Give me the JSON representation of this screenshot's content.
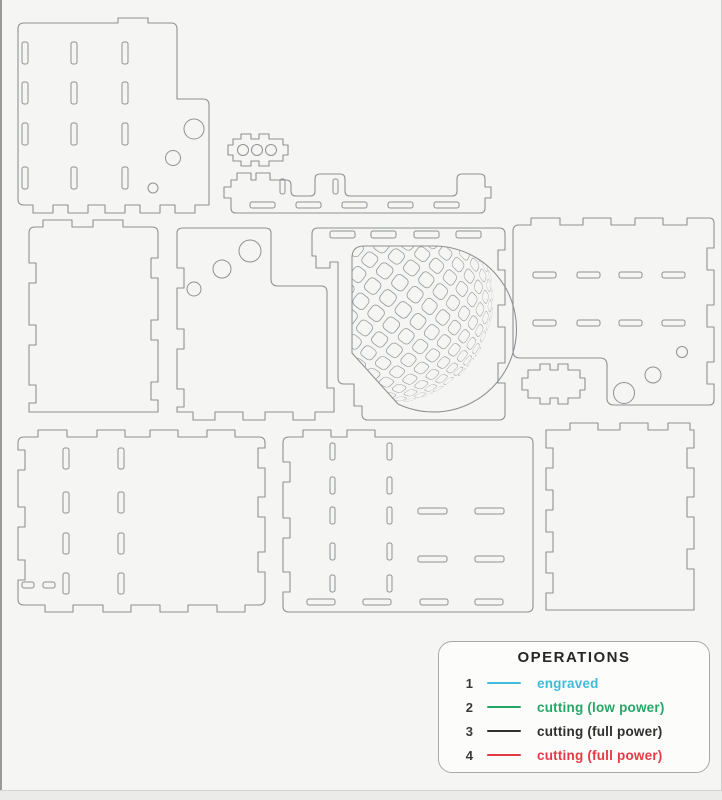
{
  "drawing": {
    "background": "#f5f5f3",
    "line_color": "#8f9193",
    "dimple_color": "#9aa0a3",
    "panels": [
      {
        "name": "panel-top-left",
        "outline": "M 24,23 H 118 V 18 H 148 V 23 H 171 Q 177,23 177,29 V 99 H 203 Q 209,99 209,105 V 205 H 195 V 213 H 175 V 205 H 160 V 213 H 140 V 205 H 125 V 213 H 105 V 205 H 88 V 213 H 68 V 205 H 53 V 213 H 33 V 205 H 24 Q 18,205 18,199 V 29 Q 18,23 24,23 Z",
        "slots": [
          [
            22,
            42,
            6,
            22
          ],
          [
            22,
            82,
            6,
            22
          ],
          [
            22,
            123,
            6,
            22
          ],
          [
            22,
            167,
            6,
            22
          ],
          [
            71,
            42,
            6,
            22
          ],
          [
            71,
            82,
            6,
            22
          ],
          [
            71,
            123,
            6,
            22
          ],
          [
            71,
            167,
            6,
            22
          ],
          [
            122,
            42,
            6,
            22
          ],
          [
            122,
            82,
            6,
            22
          ],
          [
            122,
            123,
            6,
            22
          ],
          [
            122,
            167,
            6,
            22
          ]
        ],
        "circles": [
          [
            194,
            129,
            10
          ],
          [
            173,
            158,
            7.5
          ],
          [
            153,
            188,
            5
          ]
        ]
      },
      {
        "name": "small-tabbed-plate",
        "outline": "M 228,145 V 155 H 233 V 161 H 241 V 166 H 251 V 161 H 259 V 166 H 269 V 161 H 283 V 155 H 288 V 145 H 283 V 139 H 269 V 134 H 259 V 139 H 251 V 134 H 241 V 139 H 233 V 145 Z",
        "slots": [],
        "circles": [
          [
            243,
            150,
            5.5
          ],
          [
            257,
            150,
            5.5
          ],
          [
            271,
            150,
            5.5
          ]
        ]
      },
      {
        "name": "long-rail",
        "outline": "M 231,180 H 237 V 173 H 251 V 180 H 256 V 173 H 270 V 180 H 286 Q 291,180 291,185 V 191 Q 291,196 296,196 H 310 Q 315,196 315,191 V 179 Q 315,174 320,174 H 340 Q 345,174 345,179 V 191 Q 345,196 350,196 H 452 Q 457,196 457,191 V 179 Q 457,174 462,174 H 480 Q 485,174 485,179 V 187 H 491 V 198 H 485 V 208 Q 485,213 480,213 H 236 Q 231,213 231,208 V 198 H 224 V 187 H 231 Z",
        "slots": [
          [
            280,
            179,
            5,
            15
          ],
          [
            333,
            179,
            5,
            15
          ],
          [
            250,
            202,
            25,
            6
          ],
          [
            296,
            202,
            25,
            6
          ],
          [
            342,
            202,
            25,
            6
          ],
          [
            388,
            202,
            25,
            6
          ],
          [
            434,
            202,
            25,
            6
          ]
        ],
        "circles": []
      },
      {
        "name": "panel-mid-left",
        "outline": "M 35,227 H 43 V 220 H 72 V 227 H 93 V 220 H 123 V 227 H 152 Q 158,227 158,233 V 258 H 151 V 278 H 158 V 320 H 151 V 340 H 158 V 382 H 151 V 400 H 158 V 412 H 29 V 403 H 36 V 385 H 29 V 345 H 36 V 325 H 29 V 283 H 36 V 263 H 29 V 233 Q 29,227 35,227 Z",
        "slots": [],
        "circles": []
      },
      {
        "name": "panel-mid-circles",
        "outline": "M 183,228 H 265 Q 271,228 271,233 V 279 Q 271,286 278,286 H 321 Q 327,286 327,292 V 388 H 334 V 412 H 315 V 420 H 293 V 412 H 265 V 420 H 243 V 412 H 215 V 420 H 193 V 412 H 177 V 407 H 184 V 389 H 177 V 349 H 184 V 329 H 177 V 288 H 184 V 268 H 177 V 233 Q 177,228 183,228 Z",
        "slots": [],
        "circles": [
          [
            250,
            251,
            11
          ],
          [
            222,
            269,
            9
          ],
          [
            194,
            289,
            7
          ]
        ]
      },
      {
        "name": "panel-dome",
        "outline": "M 312,234 Q 312,228 318,228 H 499 Q 505,228 505,234 V 250 H 498 V 270 H 505 V 305 H 498 V 327 H 505 V 363 H 498 V 383 H 505 V 414 Q 505,420 499,420 H 368 Q 362,420 362,414 V 406 H 354 V 384 H 344 Q 338,384 338,378 V 262 H 330 V 268 H 316 V 256 H 312 Z",
        "slots": [
          [
            330,
            231,
            25,
            7
          ],
          [
            371,
            231,
            25,
            7
          ],
          [
            414,
            231,
            25,
            7
          ],
          [
            456,
            231,
            25,
            7
          ]
        ],
        "circles": []
      },
      {
        "name": "panel-mid-right",
        "outline": "M 519,225 H 531 V 218 H 560 V 225 H 583 V 218 H 611 V 225 H 635 V 218 H 663 V 225 H 687 V 218 H 709 Q 714,218 714,223 V 248 H 707 V 270 H 714 V 305 H 707 V 327 H 714 V 362 H 707 V 384 H 714 V 400 Q 714,405 709,405 H 614 Q 607,405 607,398 V 365 Q 607,358 600,358 H 520 Q 513,358 513,351 V 231 Q 513,225 519,225 Z",
        "slots": [
          [
            533,
            272,
            23,
            6
          ],
          [
            577,
            272,
            23,
            6
          ],
          [
            619,
            272,
            23,
            6
          ],
          [
            662,
            272,
            23,
            6
          ],
          [
            533,
            320,
            23,
            6
          ],
          [
            577,
            320,
            23,
            6
          ],
          [
            619,
            320,
            23,
            6
          ],
          [
            662,
            320,
            23,
            6
          ]
        ],
        "circles": [
          [
            682,
            352,
            5.5
          ],
          [
            653,
            375,
            8
          ],
          [
            624,
            393,
            10.5
          ]
        ]
      },
      {
        "name": "small-tabbed-plate-2",
        "outline": "M 522,378 H 528 V 370 H 540 V 364 H 550 V 370 H 558 V 364 H 568 V 370 H 580 V 378 H 585 V 390 H 580 V 398 H 568 V 404 H 558 V 398 H 550 V 404 H 540 V 398 H 528 V 390 H 522 Z",
        "slots": [],
        "circles": []
      },
      {
        "name": "panel-bottom-left",
        "outline": "M 24,437 H 38 V 430 H 67 V 437 H 97 V 430 H 125 V 437 H 150 V 430 H 178 V 437 H 207 V 430 H 235 V 437 H 259 Q 265,437 265,443 V 448 H 258 V 468 H 265 V 497 H 258 V 517 H 265 V 552 H 258 V 572 H 265 V 599 Q 265,605 259,605 H 245 V 612 H 217 V 605 H 188 V 612 H 160 V 605 H 131 V 612 H 103 V 605 H 73 V 612 H 45 V 605 H 24 Q 18,605 18,599 V 580 H 25 V 560 H 18 V 527 H 25 V 507 H 18 V 470 H 25 V 450 H 18 V 443 Q 18,437 24,437 Z",
        "slots": [
          [
            63,
            448,
            6,
            21
          ],
          [
            63,
            492,
            6,
            21
          ],
          [
            63,
            533,
            6,
            21
          ],
          [
            63,
            573,
            6,
            21
          ],
          [
            118,
            448,
            6,
            21
          ],
          [
            118,
            492,
            6,
            21
          ],
          [
            118,
            533,
            6,
            21
          ],
          [
            118,
            573,
            6,
            21
          ],
          [
            22,
            582,
            12,
            6
          ],
          [
            43,
            582,
            12,
            6
          ]
        ],
        "circles": []
      },
      {
        "name": "panel-bottom-middle",
        "outline": "M 289,437 H 303 V 430 H 331 V 437 H 347 V 430 H 375 V 437 H 527 Q 533,437 533,443 V 606 Q 533,612 527,612 H 289 Q 283,612 283,606 V 592 H 290 V 572 H 283 V 538 H 290 V 518 H 283 V 482 H 290 V 462 H 283 V 443 Q 283,437 289,437 Z",
        "slots": [
          [
            330,
            443,
            5,
            17
          ],
          [
            330,
            477,
            5,
            17
          ],
          [
            330,
            507,
            5,
            17
          ],
          [
            330,
            543,
            5,
            17
          ],
          [
            330,
            575,
            5,
            17
          ],
          [
            387,
            443,
            5,
            17
          ],
          [
            387,
            477,
            5,
            17
          ],
          [
            387,
            507,
            5,
            17
          ],
          [
            387,
            543,
            5,
            17
          ],
          [
            387,
            575,
            5,
            17
          ],
          [
            418,
            508,
            29,
            6
          ],
          [
            475,
            508,
            29,
            6
          ],
          [
            418,
            556,
            29,
            6
          ],
          [
            475,
            556,
            29,
            6
          ],
          [
            307,
            599,
            28,
            6
          ],
          [
            363,
            599,
            28,
            6
          ],
          [
            420,
            599,
            28,
            6
          ],
          [
            475,
            599,
            28,
            6
          ]
        ],
        "circles": []
      },
      {
        "name": "panel-bottom-right",
        "outline": "M 552,430 H 570 V 423 H 598 V 430 H 620 V 423 H 648 V 430 H 668 V 423 H 690 V 430 H 694 V 448 H 687 V 468 H 694 V 497 H 687 V 517 H 694 V 549 H 687 V 569 H 694 V 610 H 546 V 593 H 553 V 573 H 546 V 552 H 553 V 532 H 546 V 510 H 553 V 490 H 546 V 468 H 553 V 448 H 546 V 430 Z",
        "slots": [],
        "circles": []
      }
    ],
    "dome": {
      "outline": "M 352,353 V 258 Q 352,246 364,246 H 436 A 83,83 0 1 1 398,404 Z",
      "pole": [
        388,
        298
      ],
      "radius": 105,
      "tilt": 38,
      "spacing": 19.5,
      "cell": 14.5,
      "corner": 4.5
    }
  },
  "legend": {
    "title": "OPERATIONS",
    "items": [
      {
        "num": "1",
        "color": "#3fbcd9",
        "label": "engraved"
      },
      {
        "num": "2",
        "color": "#27a567",
        "label": "cutting (low power)"
      },
      {
        "num": "3",
        "color": "#2f2f2f",
        "label": "cutting (full power)"
      },
      {
        "num": "4",
        "color": "#e63946",
        "label": "cutting (full power)"
      }
    ]
  }
}
